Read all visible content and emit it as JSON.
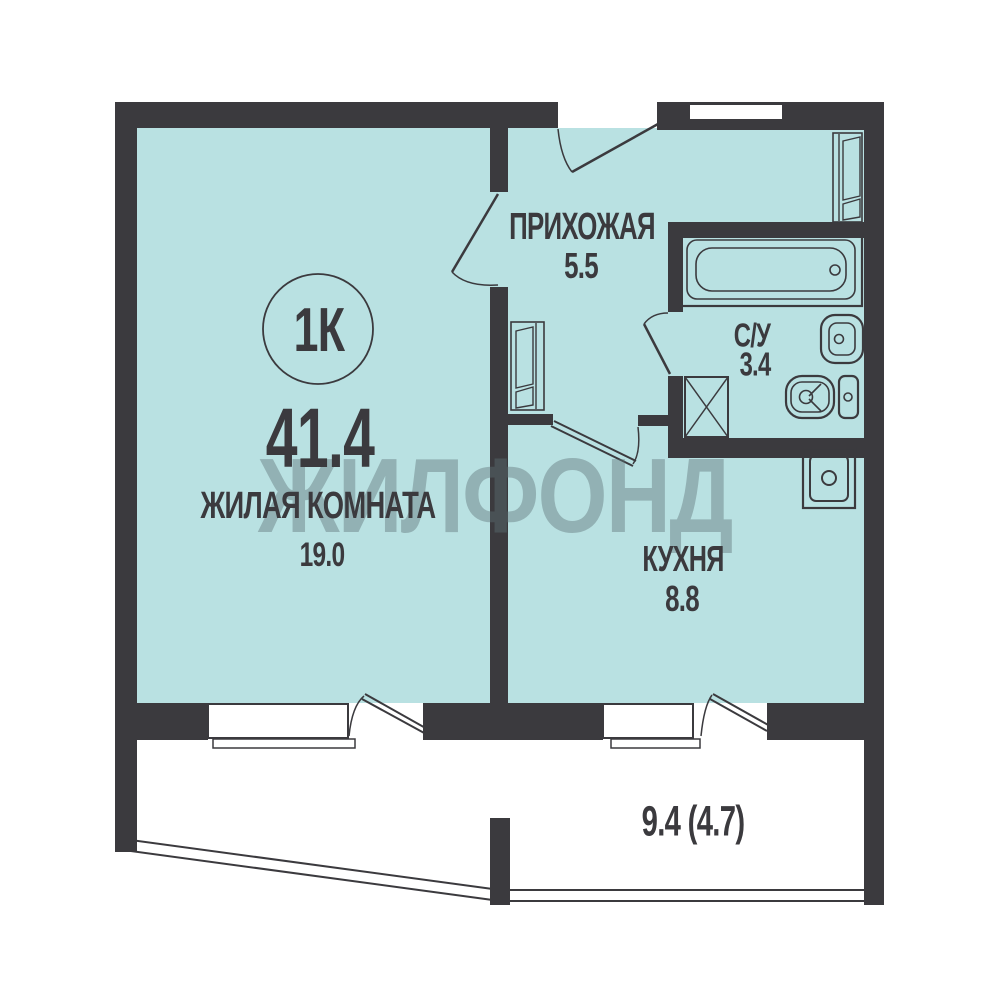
{
  "colors": {
    "background": "#ffffff",
    "room_fill": "#b9e1e2",
    "wall": "#3b3a3e",
    "text": "#3b3a3e",
    "watermark": "#5d7175"
  },
  "plan": {
    "type_badge": "1К",
    "total_area": "41.4",
    "watermark": "ЖИЛФОНД",
    "rooms": [
      {
        "name": "ЖИЛАЯ КОМНАТА",
        "area": "19.0"
      },
      {
        "name": "ПРИХОЖАЯ",
        "area": "5.5"
      },
      {
        "name": "С/У",
        "area": "3.4"
      },
      {
        "name": "КУХНЯ",
        "area": "8.8"
      },
      {
        "area": "9.4 (4.7)"
      }
    ],
    "fixtures": [
      "bathtub",
      "bathroom-sink",
      "toilet",
      "ventilation-shaft",
      "kitchen-sink",
      "wardrobe",
      "wardrobe",
      "window",
      "window",
      "balcony-parapet"
    ]
  }
}
